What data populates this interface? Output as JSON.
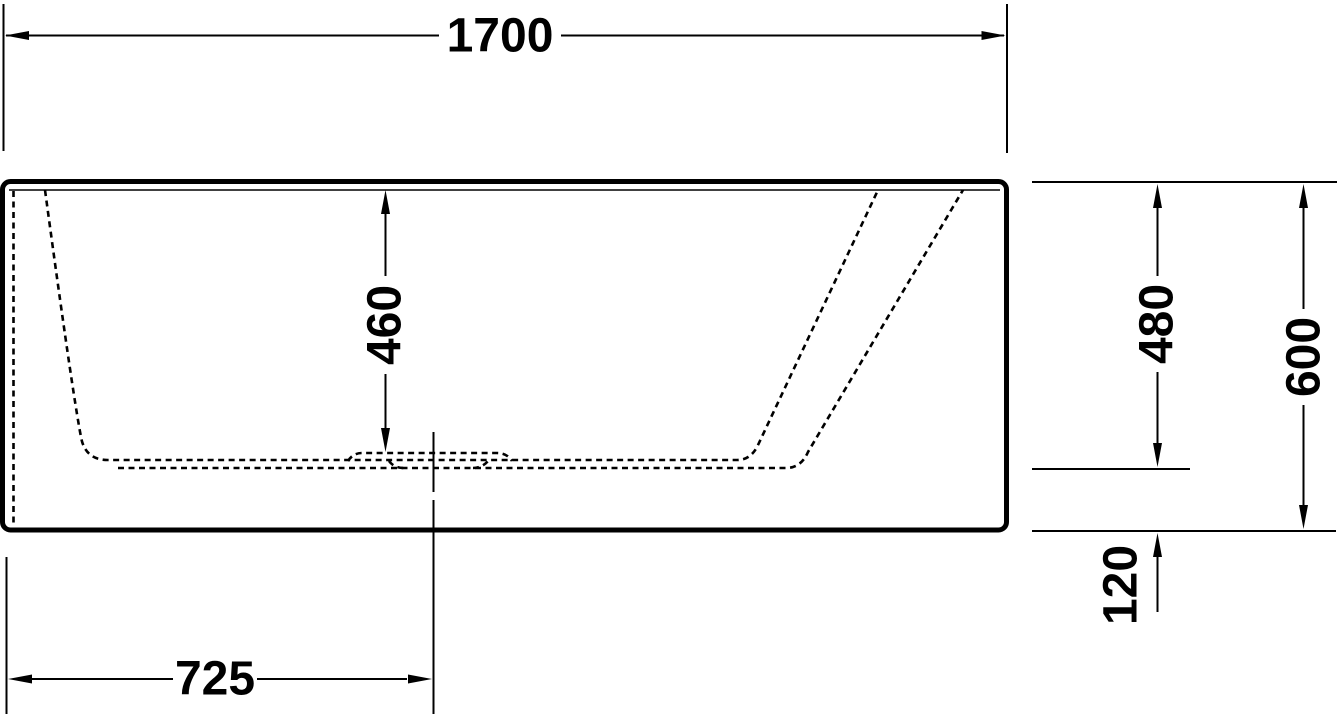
{
  "dimensions": {
    "overall_length": "1700",
    "inner_depth": "460",
    "rim_to_inner_floor": "480",
    "overall_height": "600",
    "base_height": "120",
    "drain_center_offset": "725"
  },
  "colors": {
    "line": "#000000",
    "background": "#ffffff"
  }
}
